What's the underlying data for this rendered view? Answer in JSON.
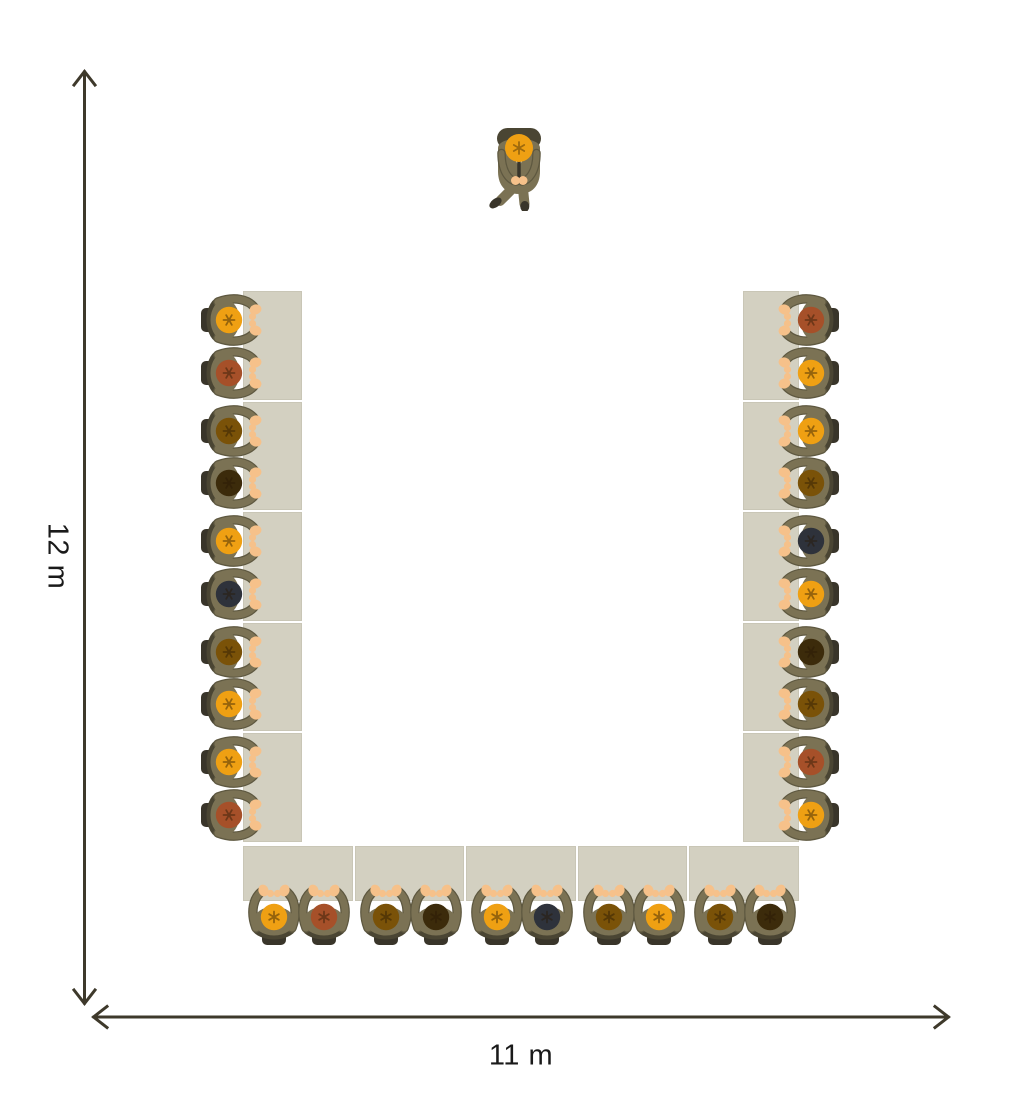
{
  "diagram": {
    "type": "room-floor-plan",
    "layout": "u-shape-seminar",
    "dimensions": {
      "height_label": "12 m",
      "width_label": "11 m"
    },
    "counts": {
      "tables": 15,
      "seated_people": 30,
      "presenters": 1
    },
    "colors": {
      "background": "#FFFFFF",
      "table": "#D3D0C1",
      "chair": "#4A4533",
      "chair_dark": "#39352A",
      "body": "#7B7254",
      "body_edge": "#5E5840",
      "skin": "#F6C18A",
      "collar": "#F3EFE4",
      "arrow": "#3E392B",
      "label_text": "#1A1A1A"
    },
    "hair_palette": {
      "orange": "#EFA013",
      "redbrown": "#A65029",
      "brown": "#7A5208",
      "darkbrown": "#3C2B0B",
      "black": "#2E323B"
    },
    "seats": {
      "left": [
        "orange",
        "redbrown",
        "brown",
        "darkbrown",
        "orange",
        "black",
        "brown",
        "orange",
        "orange",
        "redbrown"
      ],
      "right": [
        "redbrown",
        "orange",
        "orange",
        "brown",
        "black",
        "orange",
        "darkbrown",
        "brown",
        "redbrown",
        "orange"
      ],
      "bottom": [
        "orange",
        "redbrown",
        "brown",
        "darkbrown",
        "orange",
        "black",
        "brown",
        "orange",
        "brown",
        "darkbrown"
      ]
    },
    "presenter": {
      "hair": "orange"
    }
  }
}
